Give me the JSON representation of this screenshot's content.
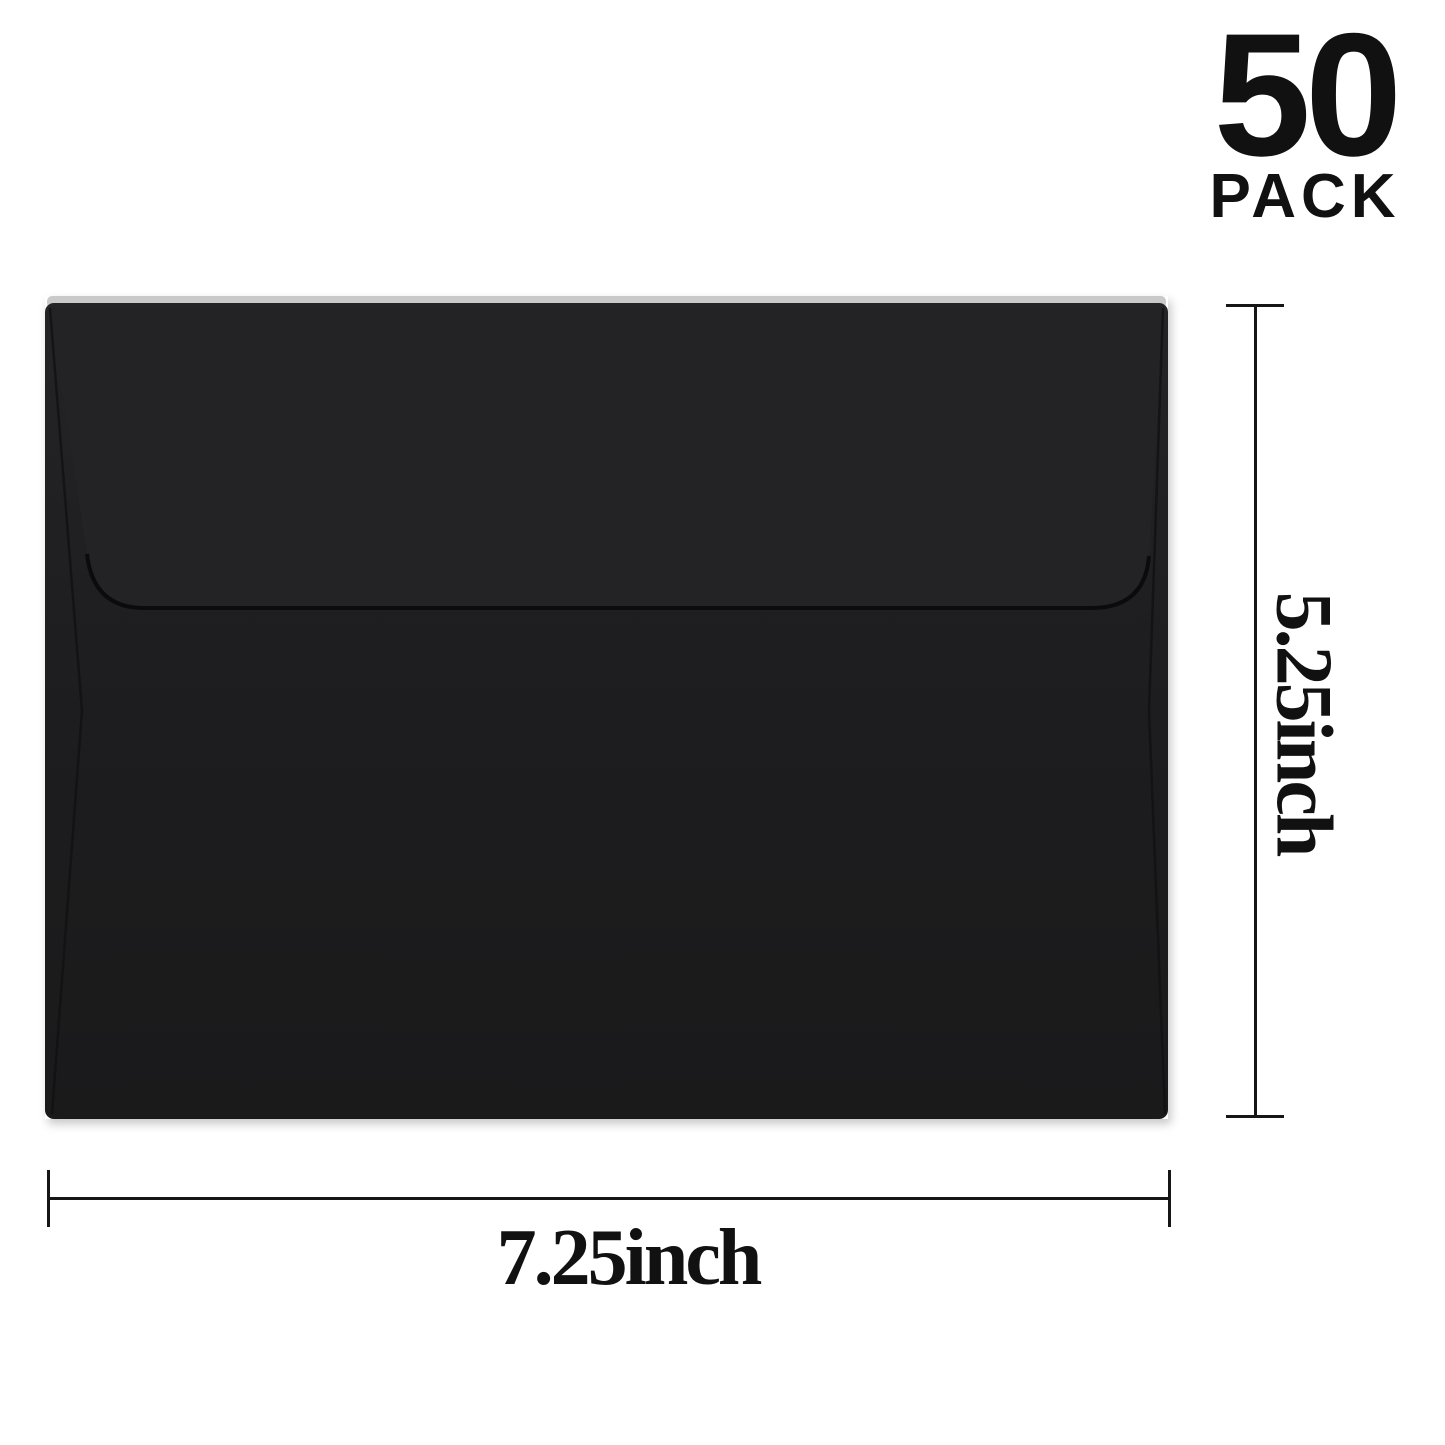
{
  "badge": {
    "count": "50",
    "unit": "PACK"
  },
  "envelope": {
    "name": "black A7 invitation envelope, back view with closed square flap",
    "body_color": "#1d1d1f",
    "flap_color": "#232326",
    "seam_color": "#0b0b0b",
    "fold_seam_color": "#121214",
    "edge_highlight_color": "#c9c9c9"
  },
  "dimensions": {
    "height": {
      "label": "5.25inch"
    },
    "width": {
      "label": "7.25inch"
    },
    "line_color": "#161616"
  },
  "background_color": "#ffffff"
}
